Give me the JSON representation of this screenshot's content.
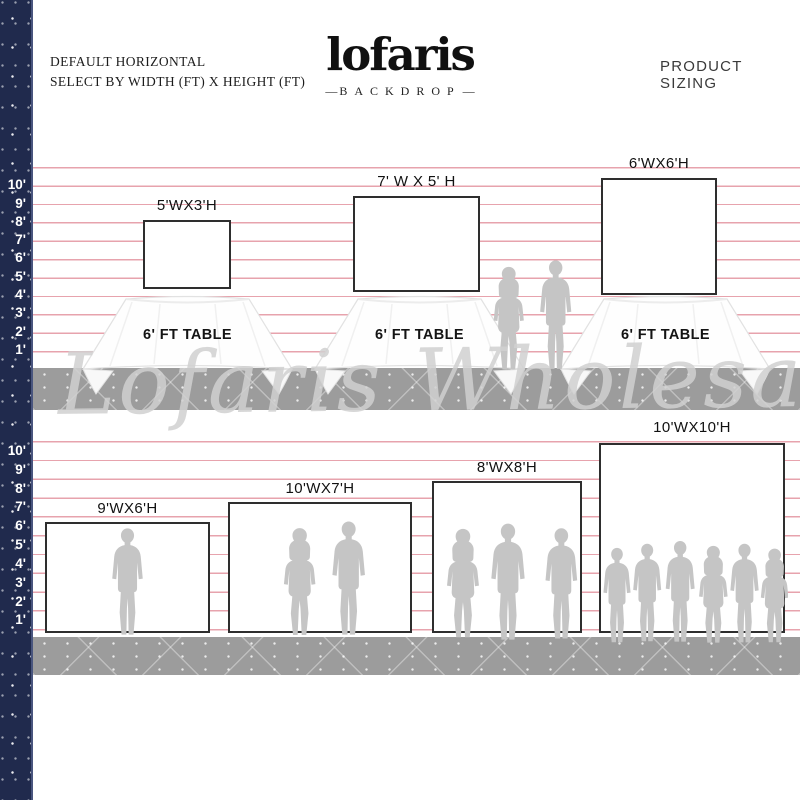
{
  "header": {
    "subtitle_line1": "DEFAULT HORIZONTAL",
    "subtitle_line2": "SELECT BY WIDTH (FT) X HEIGHT (FT)",
    "logo_text": "lofaris",
    "logo_tagline": "BACKDROP",
    "logo_dash": "—",
    "right_label": "PRODUCT SIZING"
  },
  "ruler": {
    "unit": "ft",
    "marks": [
      "10'",
      "9'",
      "8'",
      "7'",
      "6'",
      "5'",
      "4'",
      "3'",
      "2'",
      "1'"
    ]
  },
  "watermark": "Lofaris Wholesale",
  "rows": [
    {
      "name": "tabletop-backdrops",
      "items": [
        {
          "label": "5'WX3'H",
          "width_ft": 5,
          "height_ft": 3,
          "table_label": "6' FT TABLE"
        },
        {
          "label": "7' W X 5' H",
          "width_ft": 7,
          "height_ft": 5,
          "table_label": "6' FT TABLE"
        },
        {
          "label": "6'WX6'H",
          "width_ft": 6,
          "height_ft": 6,
          "table_label": "6' FT TABLE"
        }
      ]
    },
    {
      "name": "floor-backdrops",
      "items": [
        {
          "label": "9'WX6'H",
          "width_ft": 9,
          "height_ft": 6,
          "people": 1
        },
        {
          "label": "10'WX7'H",
          "width_ft": 10,
          "height_ft": 7,
          "people": 2
        },
        {
          "label": "8'WX8'H",
          "width_ft": 8,
          "height_ft": 8,
          "people": 3
        },
        {
          "label": "10'WX10'H",
          "width_ft": 10,
          "height_ft": 10,
          "people": 6
        }
      ]
    }
  ],
  "colors": {
    "strip_navy": "#202a4d",
    "scale_line_pink": "#e7a3ad",
    "floor_gray": "#9c9c9c",
    "silhouette_gray": "#c5c5c5",
    "backdrop_border": "#2e2e2e",
    "watermark_gray": "#d0d0d0"
  }
}
